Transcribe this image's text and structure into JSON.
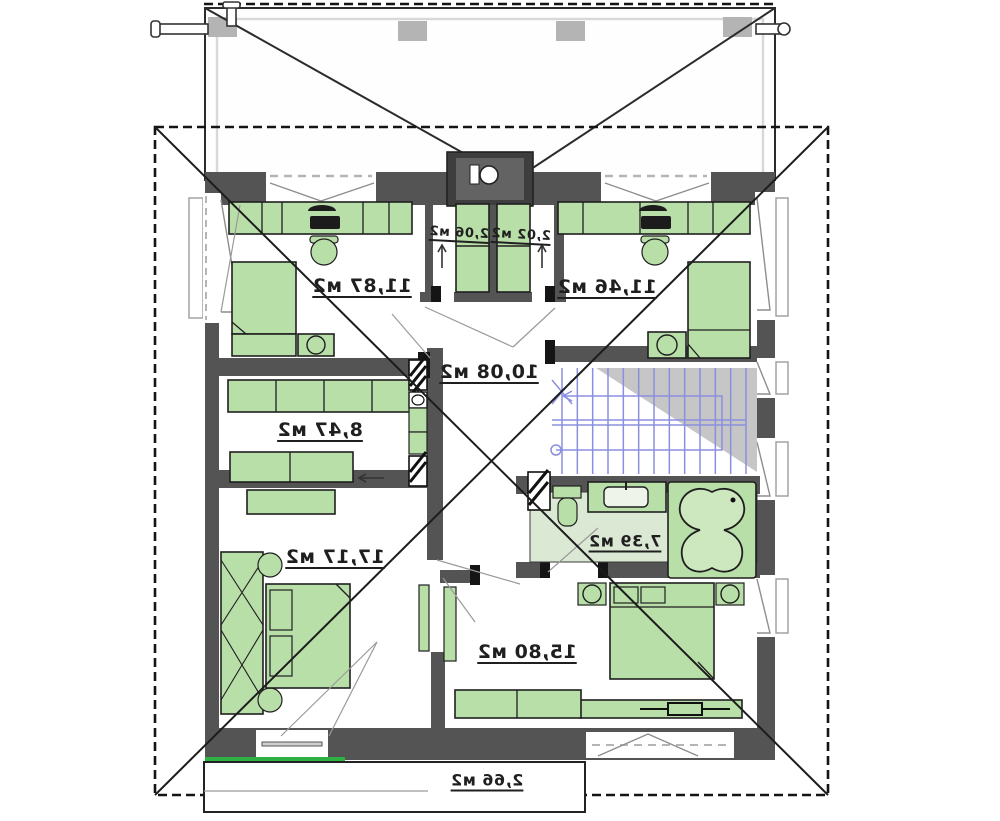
{
  "plan": {
    "kind": "architectural floor plan (mirrored print)",
    "area_unit_suffix": "м2"
  },
  "rooms": [
    {
      "id": "bedroom-top-left",
      "area_label": "11,87 м2"
    },
    {
      "id": "bedroom-top-right",
      "area_label": "11,46 м2"
    },
    {
      "id": "closet-left",
      "area_label": "2,06 м2"
    },
    {
      "id": "closet-right",
      "area_label": "2,02 м2"
    },
    {
      "id": "hall",
      "area_label": "10,08 м2"
    },
    {
      "id": "wardrobe-room",
      "area_label": "8,47 м2"
    },
    {
      "id": "bedroom-bottom-left",
      "area_label": "17,17 м2"
    },
    {
      "id": "bathroom",
      "area_label": "7,39 м2"
    },
    {
      "id": "bedroom-bottom-right",
      "area_label": "15,80 м2"
    },
    {
      "id": "balcony",
      "area_label": "2,66 м2"
    }
  ],
  "stairs": {
    "riser_count": 13,
    "flights": 2
  },
  "icons": [
    "bed-icon",
    "pillow-icon",
    "desk-icon",
    "desk-chair-icon",
    "laptop-icon",
    "desk-lamp-icon",
    "wardrobe-icon",
    "dresser-icon",
    "nightstand-icon",
    "tv-stand-icon",
    "toilet-icon",
    "sink-vanity-icon",
    "bathtub-icon",
    "stairs-icon",
    "chimney-icon",
    "roof-vent-pipe-icon",
    "door-swing-icon",
    "window-icon",
    "up-arrow-icon",
    "shaft-hatch-icon"
  ],
  "colors": {
    "wall": "#545454",
    "furniture": "#b9dfa9",
    "furniture_border": "#1f1f1f",
    "bath_floor": "#dbe8d4",
    "stair_lines": "#8a8fe0",
    "roof_shade": "#b8b8b8",
    "accent_green": "#2fb043",
    "chimney": "#3e3e3e",
    "text": "#1f1f1f"
  }
}
